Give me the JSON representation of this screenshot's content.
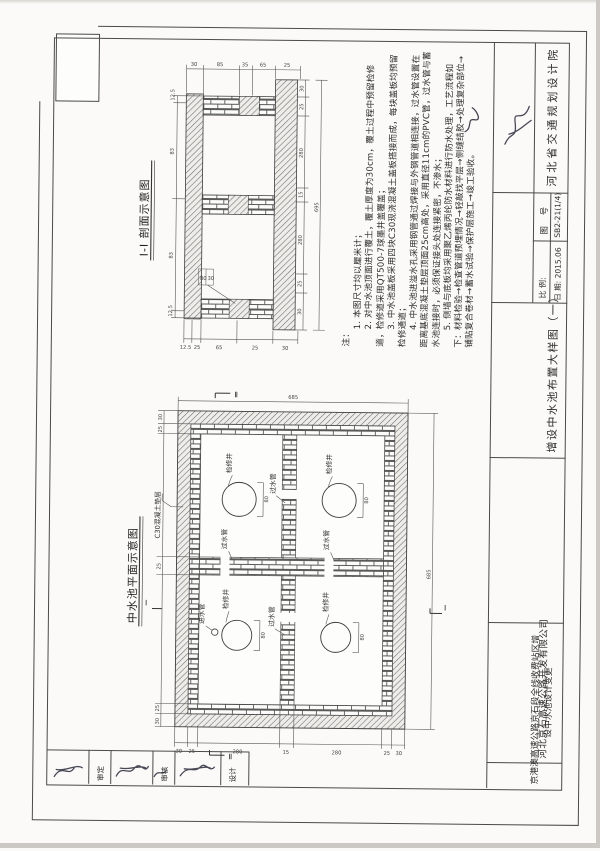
{
  "titleblock": {
    "institute": "河北省交通规划设计院",
    "drawing_no_label": "图 号",
    "drawing_no": "SB2-21(1/4)",
    "scale_label": "比 例:",
    "date_label": "日 期:",
    "date": "2015.06",
    "sheet_title": "增设中水池布置大样图（一）",
    "project_line1": "京港澳高速公路京石段全线收费站区增",
    "project_line2": "设中水池设计变更",
    "company": "河北京石高速公路开发有限公司"
  },
  "sign_row": {
    "labels": [
      "审定",
      "审核",
      "设计"
    ]
  },
  "notes": {
    "heading": "注：",
    "items": [
      "1. 本图尺寸均以厘米计；",
      "2. 对中水池顶面进行覆土，覆土厚度为30cm，覆土过程中预留检修道，检修道采用QT500-7球墨井盖覆盖；",
      "3. 中水池盖板采用四块C30现浇混凝土盖板搭接而成，每块盖板均预留检修通道；",
      "4. 中水池进溢水孔采用钢管通过焊接与外钢管道相连接，过水管设置在距离基底混凝土垫层顶面25cm高处，采用直径11cm的PVC管，过水管与蓄水池连接时，必须保证接头处连接紧密，不渗水；",
      "5. 侧墙与底板均采用聚乙烯丙纶防水材料进行防水处理，工艺流程如下：材料检验→检查管道预埋情况→轻敲找平层→侧缝结胶→处理复杂部位→铺贴复合卷材→蓄水试验→保护层施工→竣工验收。"
    ]
  },
  "section_view": {
    "title": "I-I 剖面示意图",
    "dims": {
      "top": [
        "30",
        "85",
        "35",
        "65",
        "25"
      ],
      "bottom": [
        "12.5",
        "25",
        "65",
        "25",
        "30"
      ],
      "left": [
        "12.5",
        "83",
        "83",
        "12.5"
      ],
      "right": [
        "30",
        "25",
        "280",
        "15",
        "280",
        "25",
        "30"
      ],
      "overall_right": "695",
      "opening": [
        "80",
        "30"
      ]
    }
  },
  "plan_view": {
    "title": "中水池平面示意图",
    "material_label": "C30混凝土垫层",
    "manhole_label": "检修井",
    "manhole_dim": "80",
    "pipe_label": "过水管",
    "inlet_label": "进水管",
    "marker_I": "Ⅰ",
    "marker_II": "Ⅱ",
    "dims": {
      "bottom": [
        "30",
        "25",
        "280",
        "15",
        "280",
        "25",
        "30"
      ],
      "left": [
        "30",
        "25",
        "25",
        "25",
        "30"
      ],
      "overall_top": "685",
      "overall_right": "685"
    }
  }
}
